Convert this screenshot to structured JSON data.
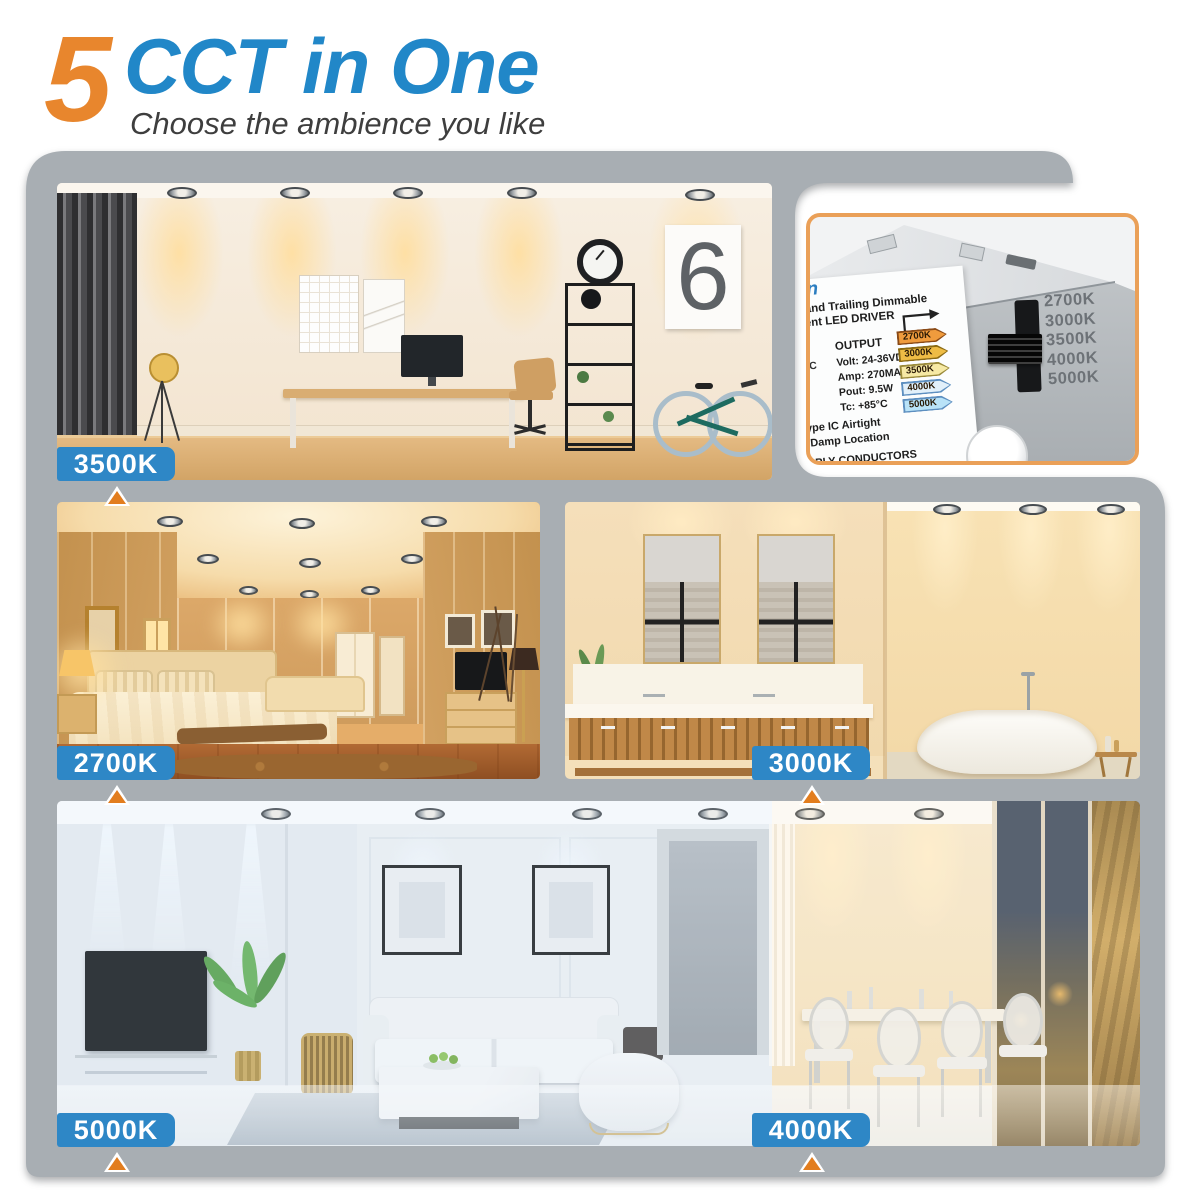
{
  "header": {
    "number": "5",
    "title": "CCT in One",
    "subtitle": "Choose the ambience you like"
  },
  "scenes": {
    "office_label": "3500K",
    "bedroom_label": "2700K",
    "bathroom_label": "3000K",
    "living_label": "5000K",
    "dining_label": "4000K",
    "office_poster_numeral": "6"
  },
  "driver_inset": {
    "logo_fragment": "un",
    "heading_line1": "c)and Trailing Dimmable",
    "heading_line2": "rrent LED DRIVER",
    "input_fragment": "AC",
    "output_heading": "OUTPUT",
    "spec_volt": "Volt: 24-36VDC",
    "spec_amp": "Amp: 270MA",
    "spec_pout": "Pout: 9.5W",
    "spec_tc": "Tc: +85°C",
    "note_line1": "ype IC Airtight",
    "note_line2": "Damp Location",
    "note_line3": "PPLY CONDUCTORS",
    "note_line4": "LIMENTATIO",
    "cct_tags": [
      {
        "label": "2700K",
        "fill": "#ef9b3d",
        "edge": "#8a4a16"
      },
      {
        "label": "3000K",
        "fill": "#eebc45",
        "edge": "#8a6a14"
      },
      {
        "label": "3500K",
        "fill": "#f6e9a4",
        "edge": "#9a8a3a"
      },
      {
        "label": "4000K",
        "fill": "#e2f0fa",
        "edge": "#5d8fc0"
      },
      {
        "label": "5000K",
        "fill": "#b9e3f8",
        "edge": "#5d8fc0"
      }
    ],
    "switch_scale": [
      "2700K",
      "3000K",
      "3500K",
      "4000K",
      "5000K"
    ]
  },
  "colors": {
    "accent_orange": "#e8862d",
    "accent_blue": "#2187c8",
    "badge_blue": "#2e87c6",
    "container_gray": "#a8aeb3",
    "inset_border": "#eaa058",
    "triangle_orange": "#e27d1e"
  }
}
